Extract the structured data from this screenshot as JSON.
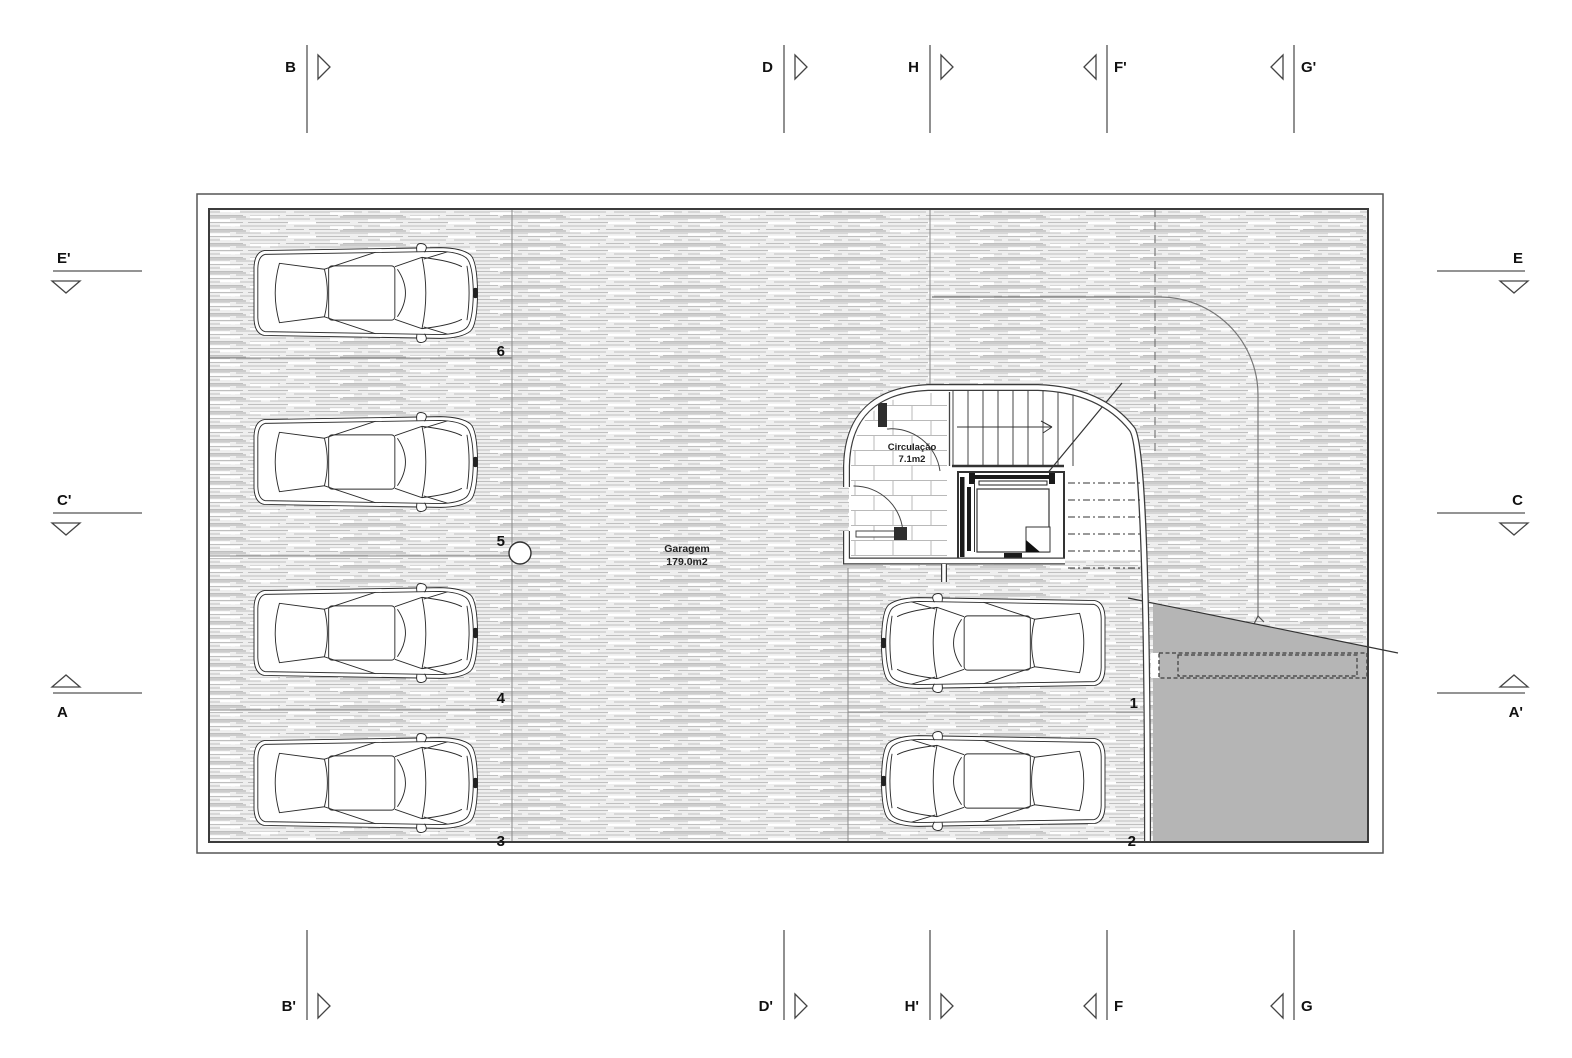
{
  "drawing": {
    "garage": {
      "name": "Garagem",
      "area": "179.0m2"
    },
    "circulation": {
      "name": "Circulação",
      "area": "7.1m2"
    },
    "bays": {
      "n1": "1",
      "n2": "2",
      "n3": "3",
      "n4": "4",
      "n5": "5",
      "n6": "6"
    }
  },
  "grid": {
    "top": {
      "b": "B",
      "d": "D",
      "h": "H",
      "f_prime": "F'",
      "g_prime": "G'"
    },
    "bottom": {
      "b_prime": "B'",
      "d_prime": "D'",
      "h_prime": "H'",
      "f": "F",
      "g": "G"
    },
    "left": {
      "e_prime": "E'",
      "c_prime": "C'",
      "a": "A"
    },
    "right": {
      "e": "E",
      "c": "C",
      "a_prime": "A'"
    }
  },
  "colors": {
    "ramp_gray": "#b5b5b5",
    "wall": "#3c3c3c",
    "hatch_line": "#c3c3c3"
  }
}
